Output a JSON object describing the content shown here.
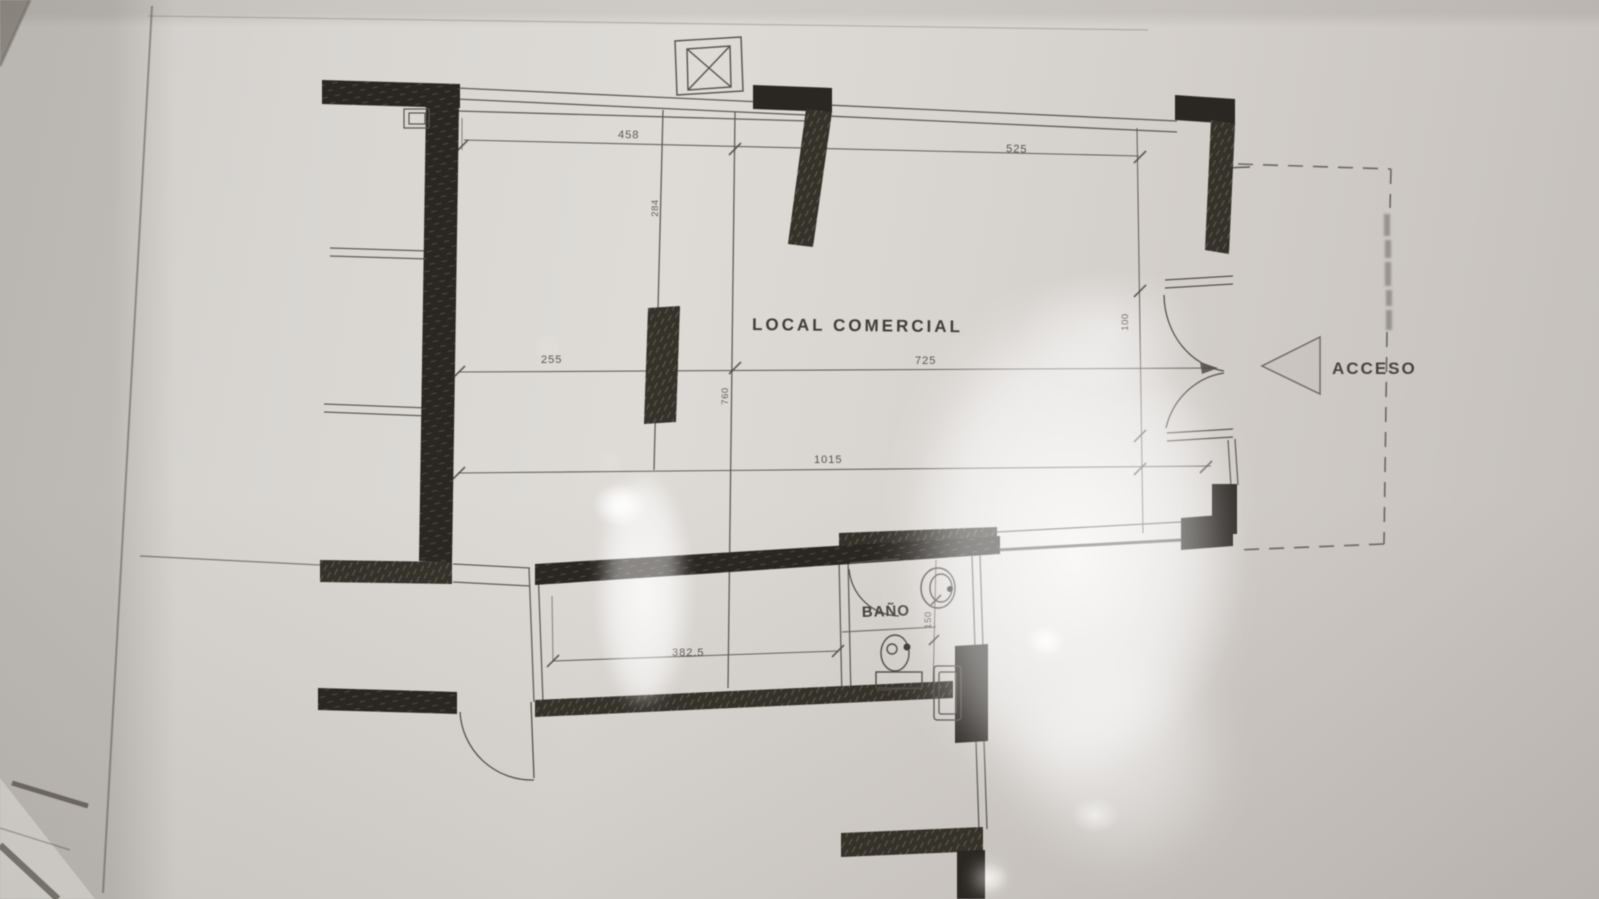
{
  "plan": {
    "room_label": "LOCAL COMERCIAL",
    "bathroom_label": "BAÑO",
    "access_label": "ACCESO",
    "dims": {
      "d458": "458",
      "d525": "525",
      "d255": "255",
      "d725": "725",
      "d1015": "1015",
      "d3825": "382.5",
      "d284": "284",
      "d760": "760",
      "d100": "100",
      "d150": "150"
    },
    "colors": {
      "paper": "#d6d2cd",
      "wall_ink": "#2c2824",
      "line_ink": "#55504a"
    }
  }
}
